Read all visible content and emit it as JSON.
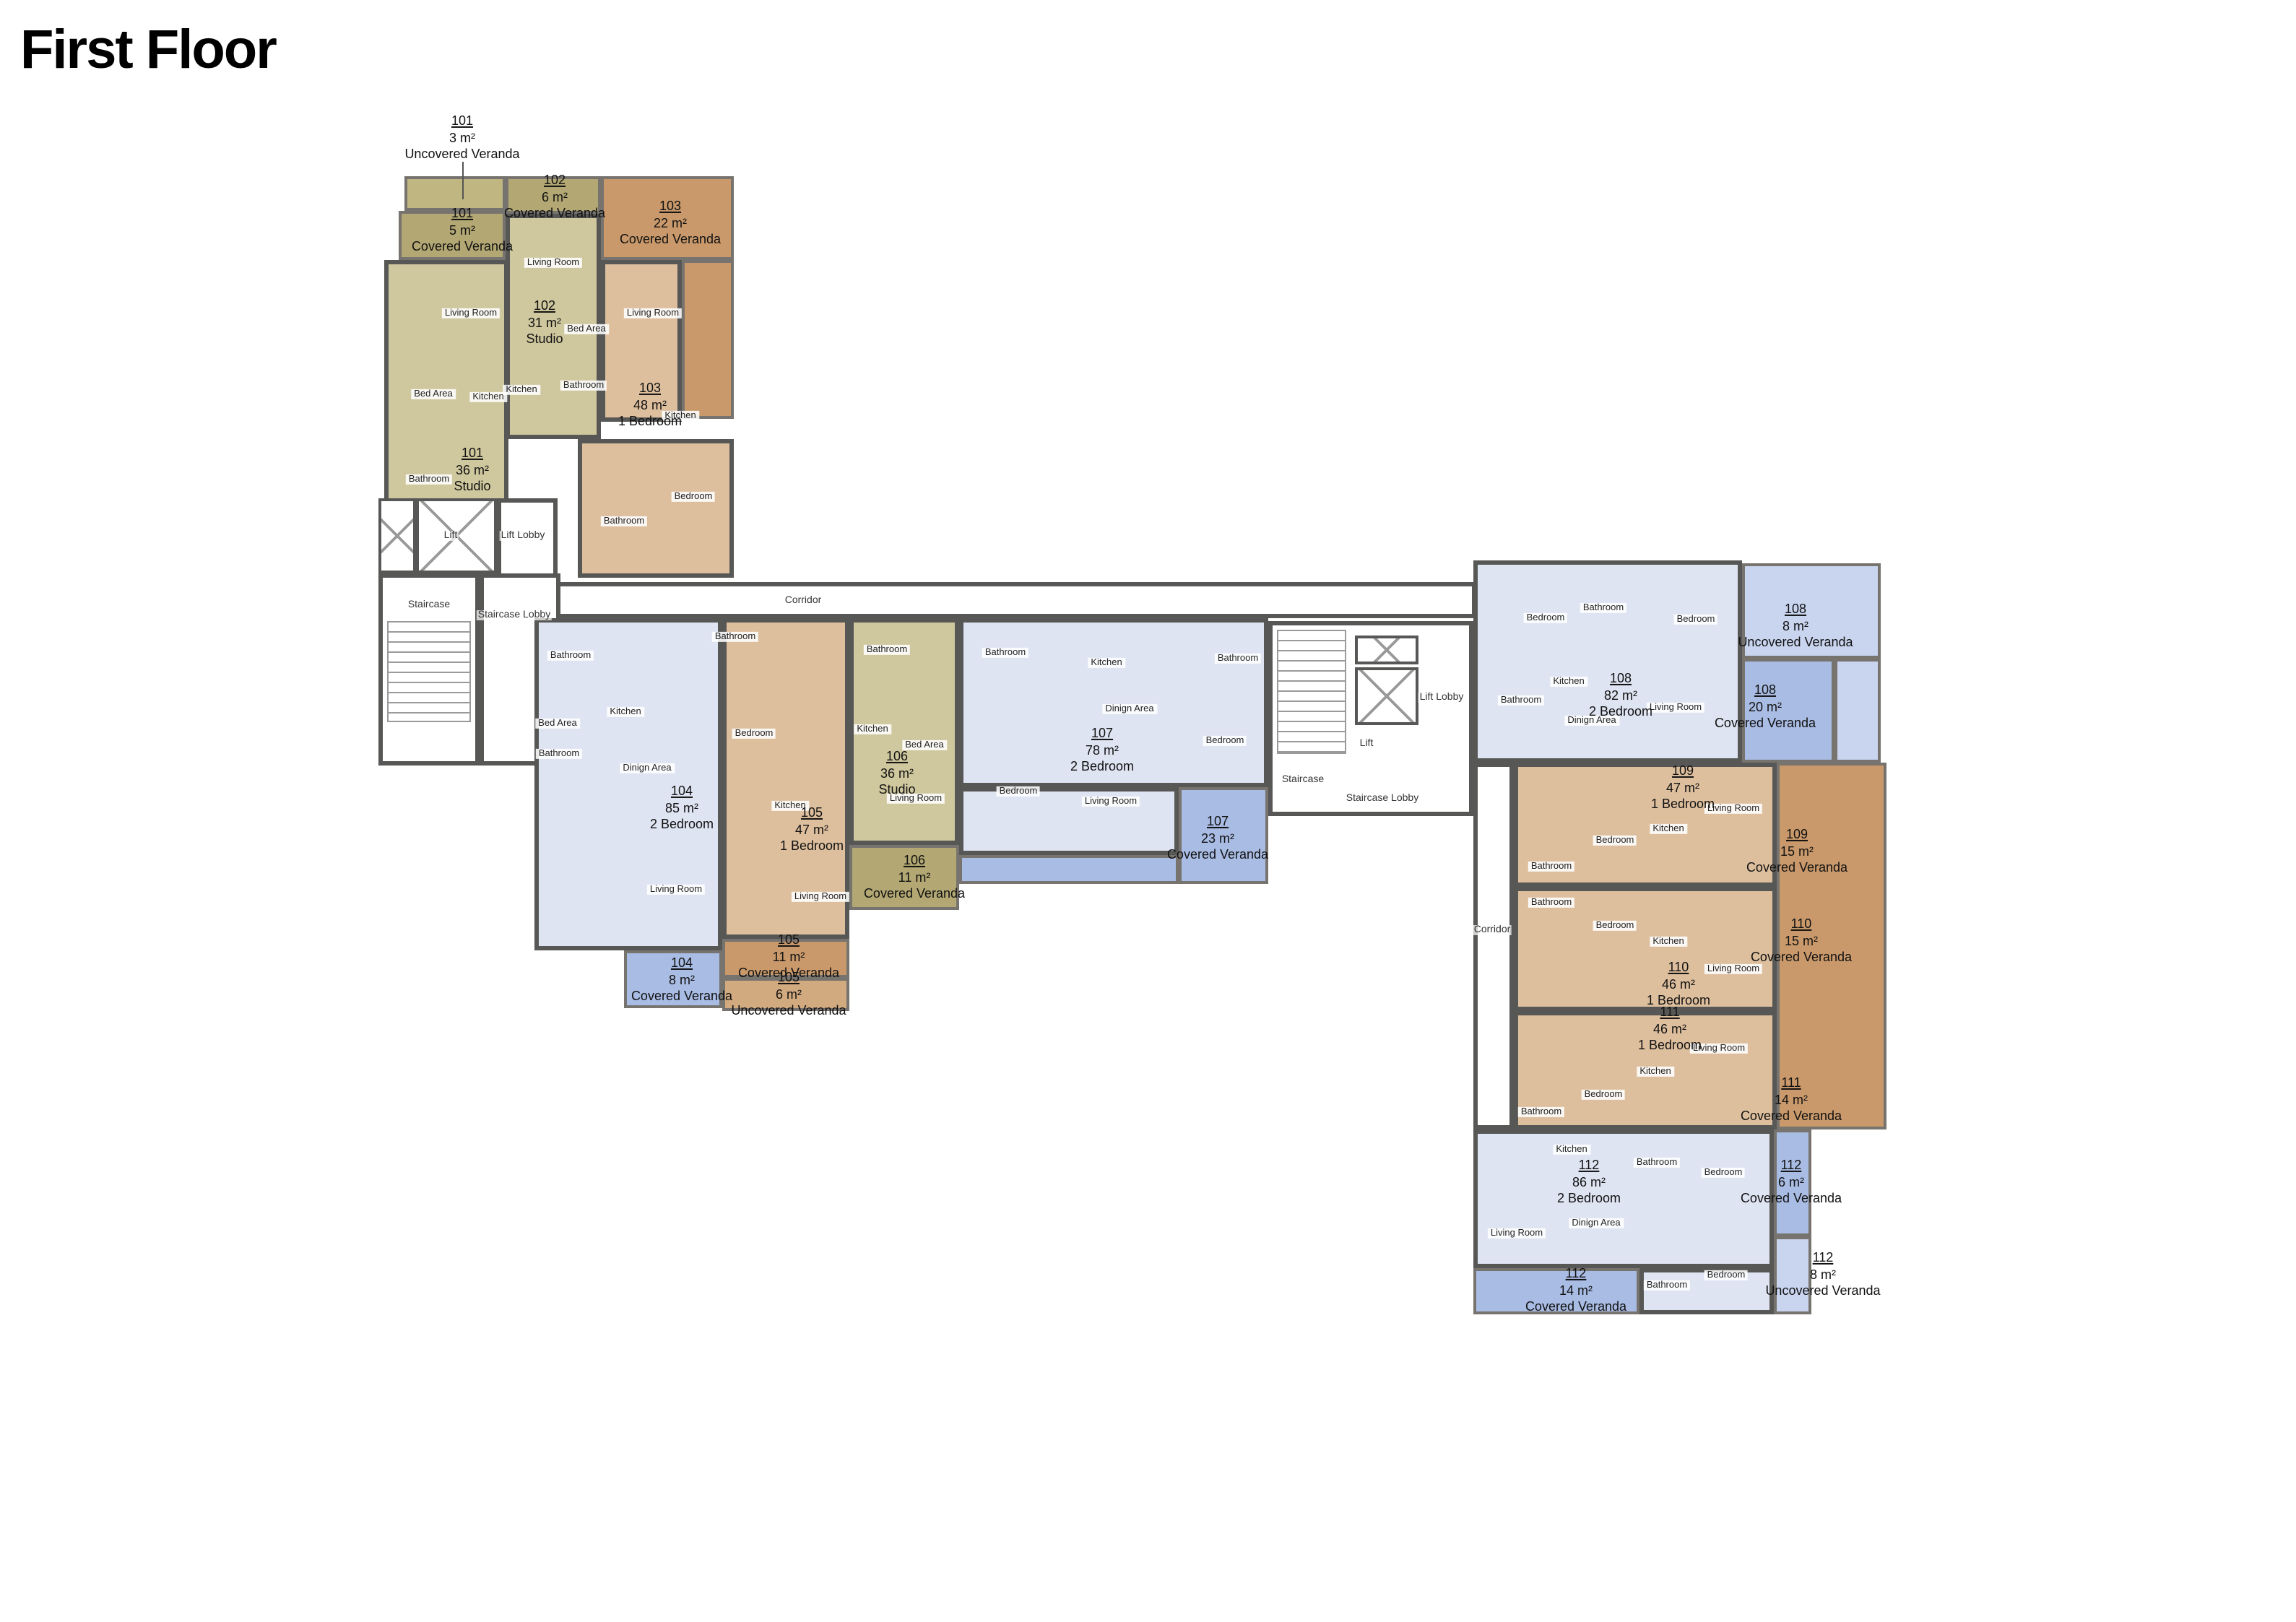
{
  "title": "First Floor",
  "colors": {
    "wall": "#575756",
    "studio_fill": "#cfc79d",
    "studio_veranda": "#b3a873",
    "one_bedroom_fill": "#ddbf9e",
    "one_bedroom_veranda": "#c9996b",
    "two_bedroom_fill": "#dfe4f2",
    "two_bedroom_veranda": "#a9bce4",
    "uncovered_veranda_blue": "#c9d4ef"
  },
  "labels": {
    "u101": {
      "num": "101",
      "area": "36 m²",
      "name": "Studio"
    },
    "u101_cv": {
      "num": "101",
      "area": "5 m²",
      "name": "Covered Veranda"
    },
    "u101_uv": {
      "num": "101",
      "area": "3 m²",
      "name": "Uncovered Veranda"
    },
    "u102": {
      "num": "102",
      "area": "31 m²",
      "name": "Studio"
    },
    "u102_cv": {
      "num": "102",
      "area": "6 m²",
      "name": "Covered Veranda"
    },
    "u103": {
      "num": "103",
      "area": "48 m²",
      "name": "1 Bedroom"
    },
    "u103_cv": {
      "num": "103",
      "area": "22 m²",
      "name": "Covered Veranda"
    },
    "u104": {
      "num": "104",
      "area": "85 m²",
      "name": "2 Bedroom"
    },
    "u104_cv": {
      "num": "104",
      "area": "8 m²",
      "name": "Covered Veranda"
    },
    "u105": {
      "num": "105",
      "area": "47 m²",
      "name": "1 Bedroom"
    },
    "u105_cv": {
      "num": "105",
      "area": "11 m²",
      "name": "Covered Veranda"
    },
    "u105_uv": {
      "num": "105",
      "area": "6 m²",
      "name": "Uncovered Veranda"
    },
    "u106": {
      "num": "106",
      "area": "36 m²",
      "name": "Studio"
    },
    "u106_cv": {
      "num": "106",
      "area": "11 m²",
      "name": "Covered Veranda"
    },
    "u107": {
      "num": "107",
      "area": "78 m²",
      "name": "2 Bedroom"
    },
    "u107_cv": {
      "num": "107",
      "area": "23 m²",
      "name": "Covered Veranda"
    },
    "u108": {
      "num": "108",
      "area": "82 m²",
      "name": "2 Bedroom"
    },
    "u108_cv": {
      "num": "108",
      "area": "20 m²",
      "name": "Covered Veranda"
    },
    "u108_uv": {
      "num": "108",
      "area": "8 m²",
      "name": "Uncovered Veranda"
    },
    "u109": {
      "num": "109",
      "area": "47 m²",
      "name": "1 Bedroom"
    },
    "u109_cv": {
      "num": "109",
      "area": "15 m²",
      "name": "Covered Veranda"
    },
    "u110": {
      "num": "110",
      "area": "46 m²",
      "name": "1 Bedroom"
    },
    "u110_cv": {
      "num": "110",
      "area": "15 m²",
      "name": "Covered Veranda"
    },
    "u111": {
      "num": "111",
      "area": "46 m²",
      "name": "1 Bedroom"
    },
    "u111_cv": {
      "num": "111",
      "area": "14 m²",
      "name": "Covered Veranda"
    },
    "u112": {
      "num": "112",
      "area": "86 m²",
      "name": "2 Bedroom"
    },
    "u112_cv_east": {
      "num": "112",
      "area": "6 m²",
      "name": "Covered Veranda"
    },
    "u112_cv_south": {
      "num": "112",
      "area": "14 m²",
      "name": "Covered Veranda"
    },
    "u112_uv": {
      "num": "112",
      "area": "8 m²",
      "name": "Uncovered Veranda"
    }
  },
  "rooms": {
    "living_room": "Living Room",
    "bedroom": "Bedroom",
    "bed_area": "Bed Area",
    "kitchen": "Kitchen",
    "bathroom": "Bathroom",
    "dining_area": "Dinign Area"
  },
  "common": {
    "lift": "Lift",
    "lift_lobby": "Lift Lobby",
    "staircase": "Staircase",
    "staircase_lobby": "Staircase Lobby",
    "corridor": "Corridor"
  }
}
